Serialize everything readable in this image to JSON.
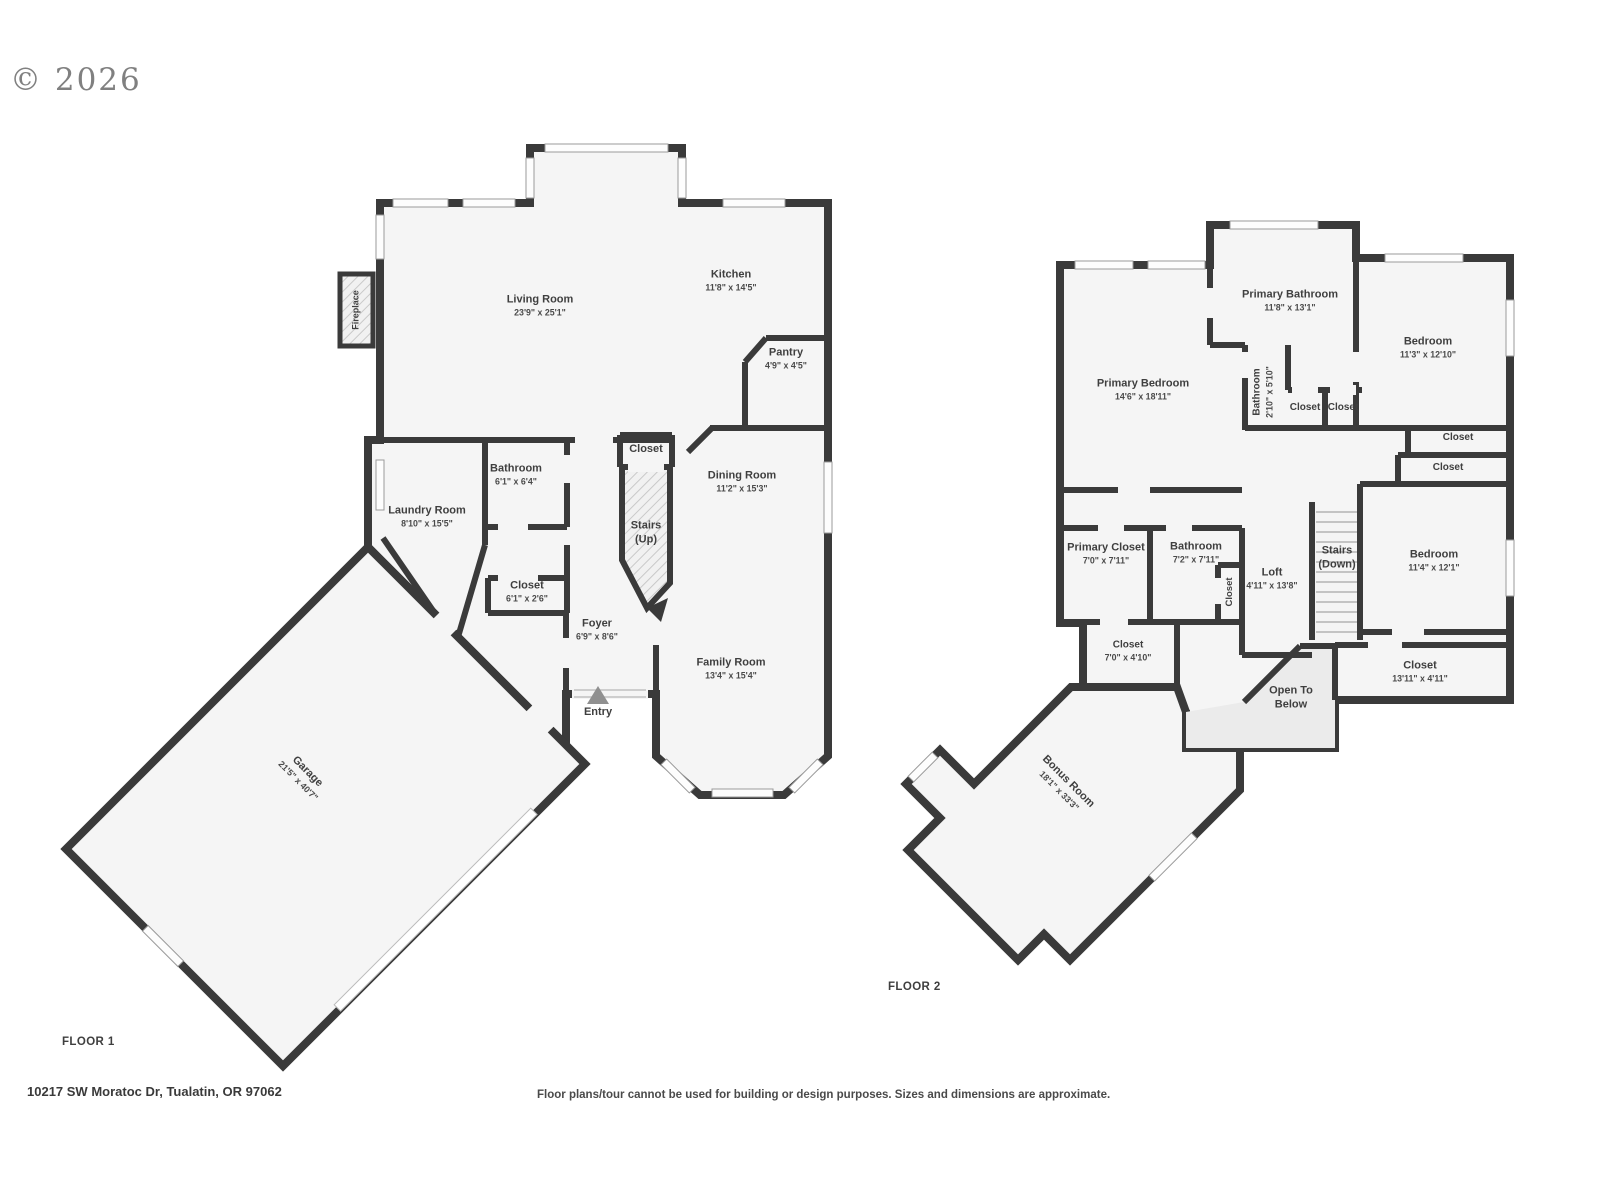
{
  "copyright": "© 2026",
  "colors": {
    "wall": "#3a3a3a",
    "floor": "#f5f5f5",
    "open_below_shade": "#ebebeb",
    "stair_hatch": "#c9c9c9",
    "text": "#3f3f3f",
    "entry_arrow": "#909090"
  },
  "floor1": {
    "label": "FLOOR 1",
    "rooms": {
      "living": {
        "name": "Living Room",
        "dims": "23'9\" x 25'1\""
      },
      "kitchen": {
        "name": "Kitchen",
        "dims": "11'8\" x 14'5\""
      },
      "pantry": {
        "name": "Pantry",
        "dims": "4'9\" x 4'5\""
      },
      "bathroom": {
        "name": "Bathroom",
        "dims": "6'1\" x 6'4\""
      },
      "laundry": {
        "name": "Laundry Room",
        "dims": "8'10\" x 15'5\""
      },
      "closet_hall": {
        "name": "Closet",
        "dims": "6'1\" x 2'6\""
      },
      "closet_stairs": {
        "name": "Closet"
      },
      "stairs_up": {
        "name": "Stairs",
        "sub": "(Up)"
      },
      "dining": {
        "name": "Dining Room",
        "dims": "11'2\" x 15'3\""
      },
      "foyer": {
        "name": "Foyer",
        "dims": "6'9\" x 8'6\""
      },
      "family": {
        "name": "Family Room",
        "dims": "13'4\" x 15'4\""
      },
      "entry": {
        "name": "Entry"
      },
      "garage": {
        "name": "Garage",
        "dims": "21'5\" x 40'7\""
      },
      "fireplace": {
        "name": "Fireplace"
      }
    }
  },
  "floor2": {
    "label": "FLOOR 2",
    "rooms": {
      "primary_bathroom": {
        "name": "Primary Bathroom",
        "dims": "11'8\" x 13'1\""
      },
      "primary_bedroom": {
        "name": "Primary Bedroom",
        "dims": "14'6\" x 18'11\""
      },
      "bathroom_small": {
        "name": "Bathroom",
        "dims": "2'10\" x 5'10\""
      },
      "closet_a": {
        "name": "Closet"
      },
      "closet_b": {
        "name": "Closet"
      },
      "bedroom_tr": {
        "name": "Bedroom",
        "dims": "11'3\" x 12'10\""
      },
      "closet_strip1": {
        "name": "Closet"
      },
      "closet_strip2": {
        "name": "Closet"
      },
      "primary_closet": {
        "name": "Primary Closet",
        "dims": "7'0\" x 7'11\""
      },
      "bathroom2": {
        "name": "Bathroom",
        "dims": "7'2\" x 7'11\""
      },
      "closet_vert": {
        "name": "Closet"
      },
      "loft": {
        "name": "Loft",
        "dims": "4'11\" x 13'8\""
      },
      "stairs_down": {
        "name": "Stairs",
        "sub": "(Down)"
      },
      "bedroom_r": {
        "name": "Bedroom",
        "dims": "11'4\" x 12'1\""
      },
      "closet_c": {
        "name": "Closet",
        "dims": "7'0\" x 4'10\""
      },
      "open_below": {
        "name": "Open To",
        "sub": "Below"
      },
      "closet_1311": {
        "name": "Closet",
        "dims": "13'11\" x 4'11\""
      },
      "bonus": {
        "name": "Bonus Room",
        "dims": "18'1\" x 33'3\""
      }
    }
  },
  "footer": {
    "address": "10217 SW Moratoc Dr, Tualatin, OR 97062",
    "disclaimer": "Floor plans/tour cannot be used for building or design purposes. Sizes and dimensions are approximate."
  }
}
